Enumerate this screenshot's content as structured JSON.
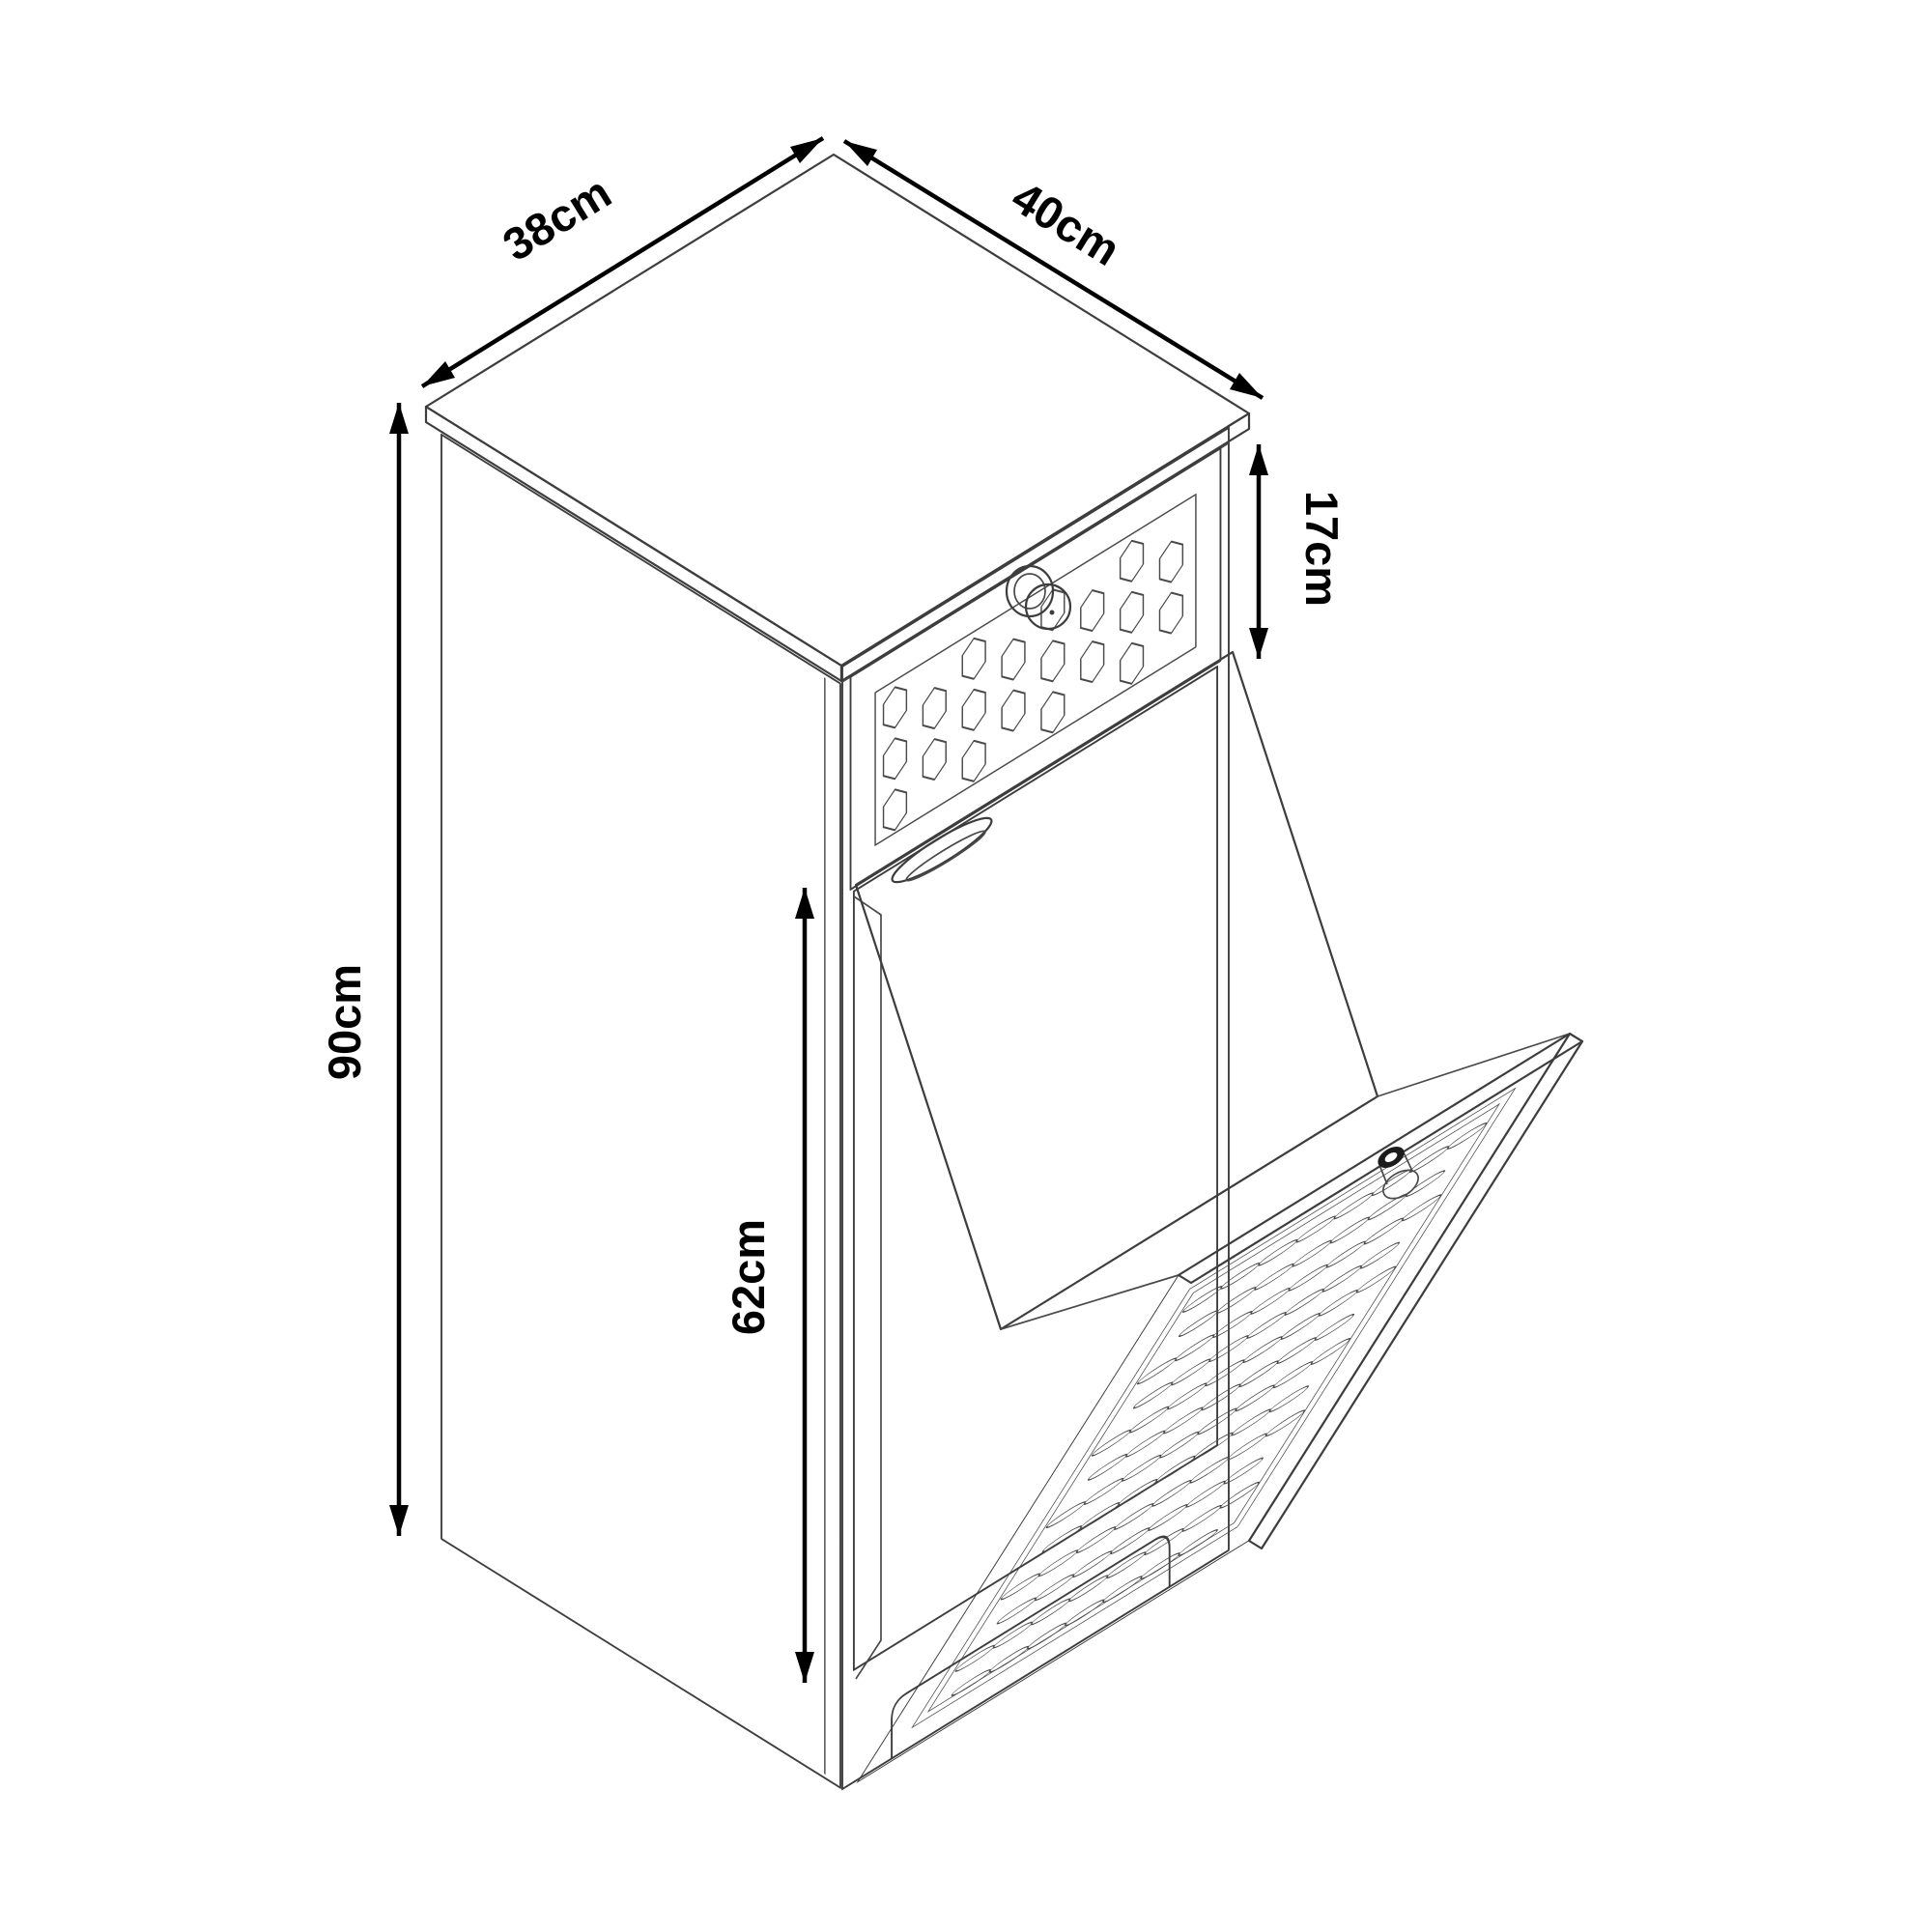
{
  "diagram": {
    "type": "technical-line-drawing",
    "subject": "tilt-out laundry hamper cabinet with top drawer, isometric view with dimension arrows",
    "background_color": "#ffffff",
    "line_color": "#3d3d3d",
    "dimension_color": "#000000",
    "dimensions": {
      "top_depth": "38cm",
      "top_width": "40cm",
      "drawer_height": "17cm",
      "overall_height": "90cm",
      "hamper_door_height": "62cm"
    }
  }
}
